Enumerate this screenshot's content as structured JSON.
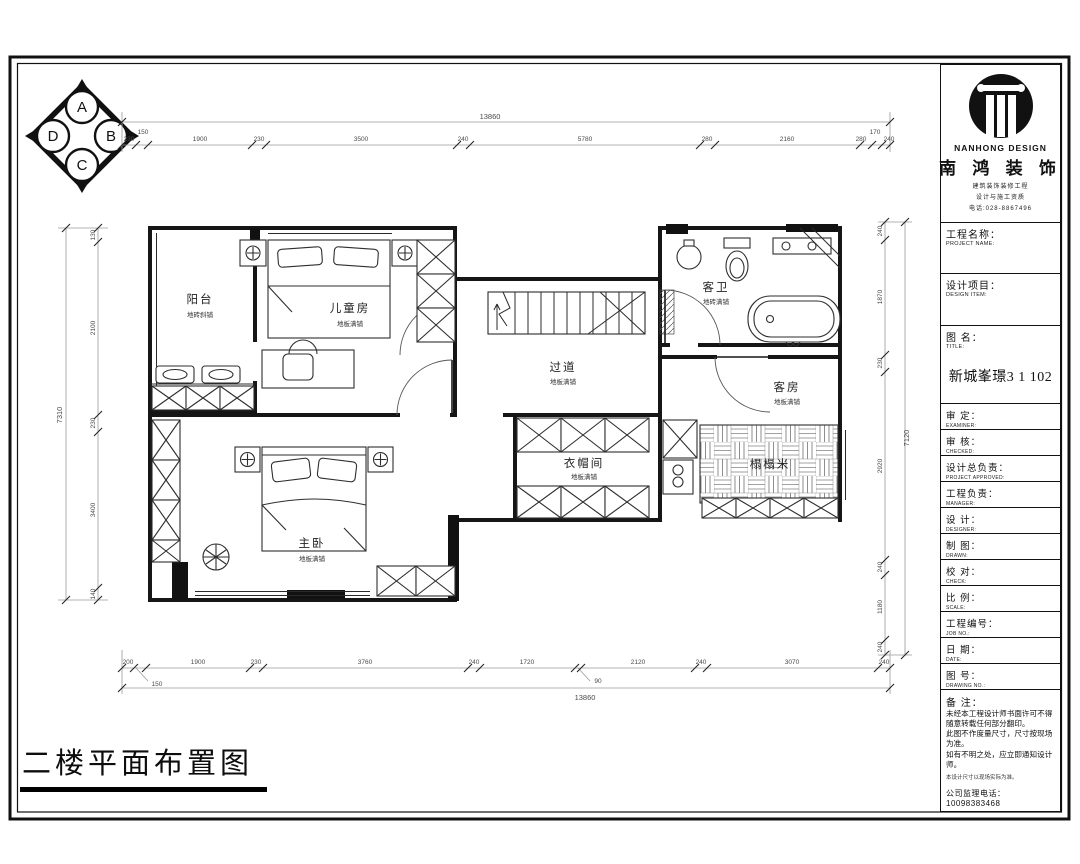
{
  "drawing_title": "二楼平面布置图",
  "compass": {
    "top": "A",
    "right": "B",
    "bottom": "C",
    "left": "D"
  },
  "rooms": {
    "balcony": {
      "name": "阳台",
      "finish": "地砖斜铺"
    },
    "kids_room": {
      "name": "儿童房",
      "finish": "地板满铺"
    },
    "hallway": {
      "name": "过道",
      "finish": "地板满铺"
    },
    "guest_bath": {
      "name": "客卫",
      "finish": "地砖满铺"
    },
    "guest_room": {
      "name": "客房",
      "finish": "地板满铺"
    },
    "cloakroom": {
      "name": "衣帽间",
      "finish": "地板满铺"
    },
    "tatami": {
      "name": "榻榻米"
    },
    "master_bedroom": {
      "name": "主卧",
      "finish": "地板满铺"
    }
  },
  "dimensions": {
    "top": {
      "total": "13860",
      "segments": [
        "230",
        "150",
        "1900",
        "230",
        "3500",
        "240",
        "5780",
        "280",
        "2160",
        "280",
        "170",
        "240"
      ]
    },
    "bottom": {
      "total": "13860",
      "segments": [
        "200",
        "150",
        "1900",
        "230",
        "3760",
        "240",
        "1720",
        "90",
        "2120",
        "240",
        "3070",
        "240"
      ]
    },
    "left": {
      "total": "7310",
      "segments": [
        "130",
        "2100",
        "230",
        "3400",
        "140"
      ]
    },
    "right": {
      "total": "7120",
      "segments": [
        "240",
        "1870",
        "230",
        "2920",
        "240",
        "1180",
        "240"
      ]
    }
  },
  "title_block": {
    "brand": {
      "en": "NANHONG DESIGN",
      "cn": "南 鸿 装 饰",
      "line1": "建筑装饰装修工程",
      "line2": "设计与施工资质",
      "line3": "电话:028-8867496"
    },
    "drawing_name": "新城峯璟3 1 102",
    "fields": [
      {
        "cn": "工程名称：",
        "en": "PROJECT NAME:"
      },
      {
        "cn": "设计项目：",
        "en": "DESIGN ITEM:"
      },
      {
        "cn": "图  名：",
        "en": "TITLE:"
      },
      {
        "cn": "审  定：",
        "en": "EXAMINER:"
      },
      {
        "cn": "审  核：",
        "en": "CHECKED:"
      },
      {
        "cn": "设计总负责：",
        "en": "PROJECT APPROVED:"
      },
      {
        "cn": "工程负责：",
        "en": "MANAGER:"
      },
      {
        "cn": "设  计：",
        "en": "DESIGNER:"
      },
      {
        "cn": "制  图：",
        "en": "DRAWN:"
      },
      {
        "cn": "校  对：",
        "en": "CHECK:"
      },
      {
        "cn": "比  例：",
        "en": "SCALE:"
      },
      {
        "cn": "工程编号：",
        "en": "JOB NO.:"
      },
      {
        "cn": "日  期：",
        "en": "DATE:"
      },
      {
        "cn": "图  号：",
        "en": "DRAWING NO.:"
      },
      {
        "cn": "备  注：",
        "en": ""
      }
    ],
    "notes": {
      "lines": [
        "未经本工程设计师书面许可不得",
        "随意转载任何部分翻印。",
        "此图不作度量尺寸，尺寸按现场",
        "为准。",
        "如有不明之处，应立即通知设计",
        "师。"
      ],
      "fine_print": "本设计尺寸以现场实际为准。",
      "phone": "公司监理电话：10098383468"
    }
  }
}
